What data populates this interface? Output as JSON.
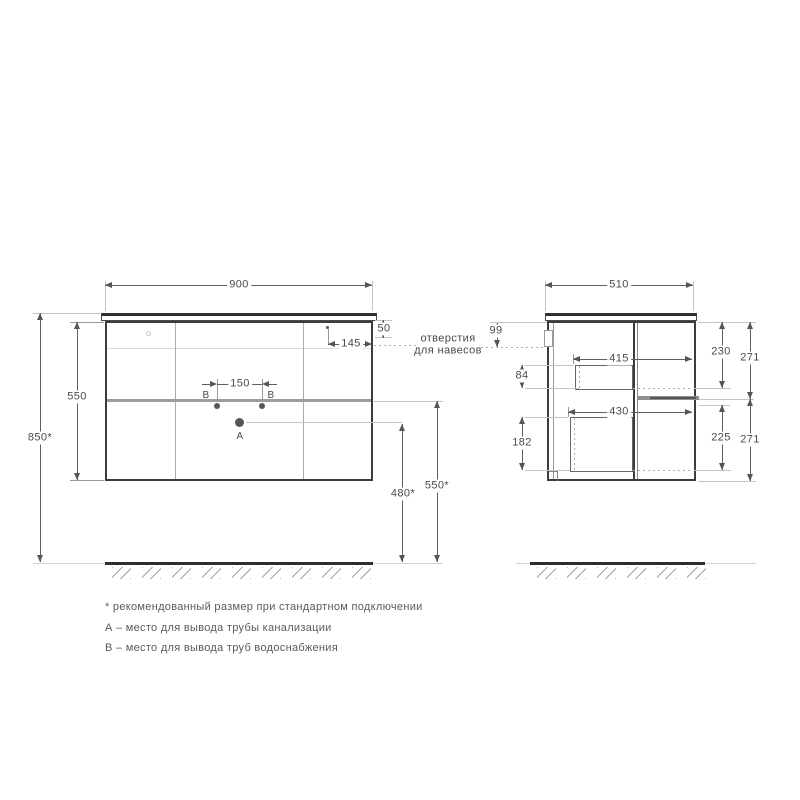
{
  "front_view": {
    "dims": {
      "width": "900",
      "cabinet_height": "550",
      "mount_height": "850*",
      "hanger_top": "50",
      "hanger_right": "145",
      "pipes_spacing": "150",
      "drain_outlet_height": "480*",
      "water_outlet_height": "550*"
    },
    "labels": {
      "a": "А",
      "b_left": "В",
      "b_right": "В"
    }
  },
  "side_view": {
    "dims": {
      "depth": "510",
      "hanger_back": "99",
      "upper_inner": "84",
      "lower_inner": "182",
      "upper_depth": "415",
      "lower_depth": "430",
      "upper_opening": "230",
      "upper_front": "271",
      "lower_opening": "225",
      "lower_front": "271"
    }
  },
  "callout": {
    "line1": "отверстия",
    "line2": "для навесов"
  },
  "notes": {
    "asterisk": "* рекомендованный размер при стандартном подключении",
    "a": "А – место для вывода трубы канализации",
    "b": "В – место для вывода труб водоснабжения"
  }
}
